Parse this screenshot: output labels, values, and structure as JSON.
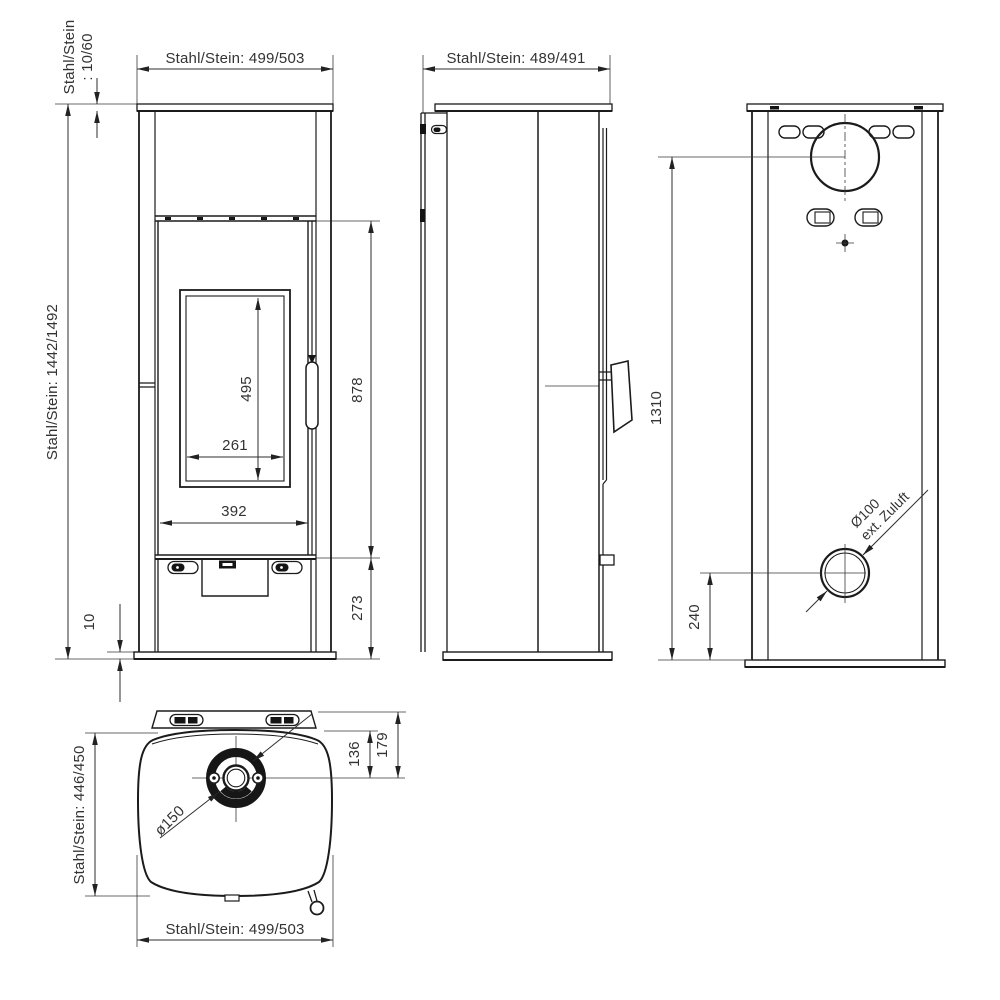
{
  "drawing": {
    "type": "stove-technical-dimension-drawing",
    "colors": {
      "line": "#1b1b1b",
      "dimension": "#2e2e2e",
      "text": "#333333",
      "background": "#ffffff"
    },
    "front": {
      "top_width": "Stahl/Stein: 499/503",
      "plate_thickness_1": "Stahl/Stein",
      "plate_thickness_2": ": 10/60",
      "total_height": "Stahl/Stein: 1442/1492",
      "glass_height": "495",
      "glass_width": "261",
      "door_width": "392",
      "door_height": "878",
      "lower_height": "273",
      "floor_gap": "10"
    },
    "side": {
      "top_depth": "Stahl/Stein: 489/491"
    },
    "back": {
      "flue_center_height": "1310",
      "air_inlet_height": "240",
      "air_inlet_dia": "Ø100",
      "air_inlet_name": "ext. Zuluft"
    },
    "top": {
      "body_depth": "Stahl/Stein: 446/450",
      "body_width": "Stahl/Stein: 499/503",
      "flue_dia": "ø150",
      "dist_flue_to_body": "136",
      "dist_flue_to_back": "179"
    }
  }
}
